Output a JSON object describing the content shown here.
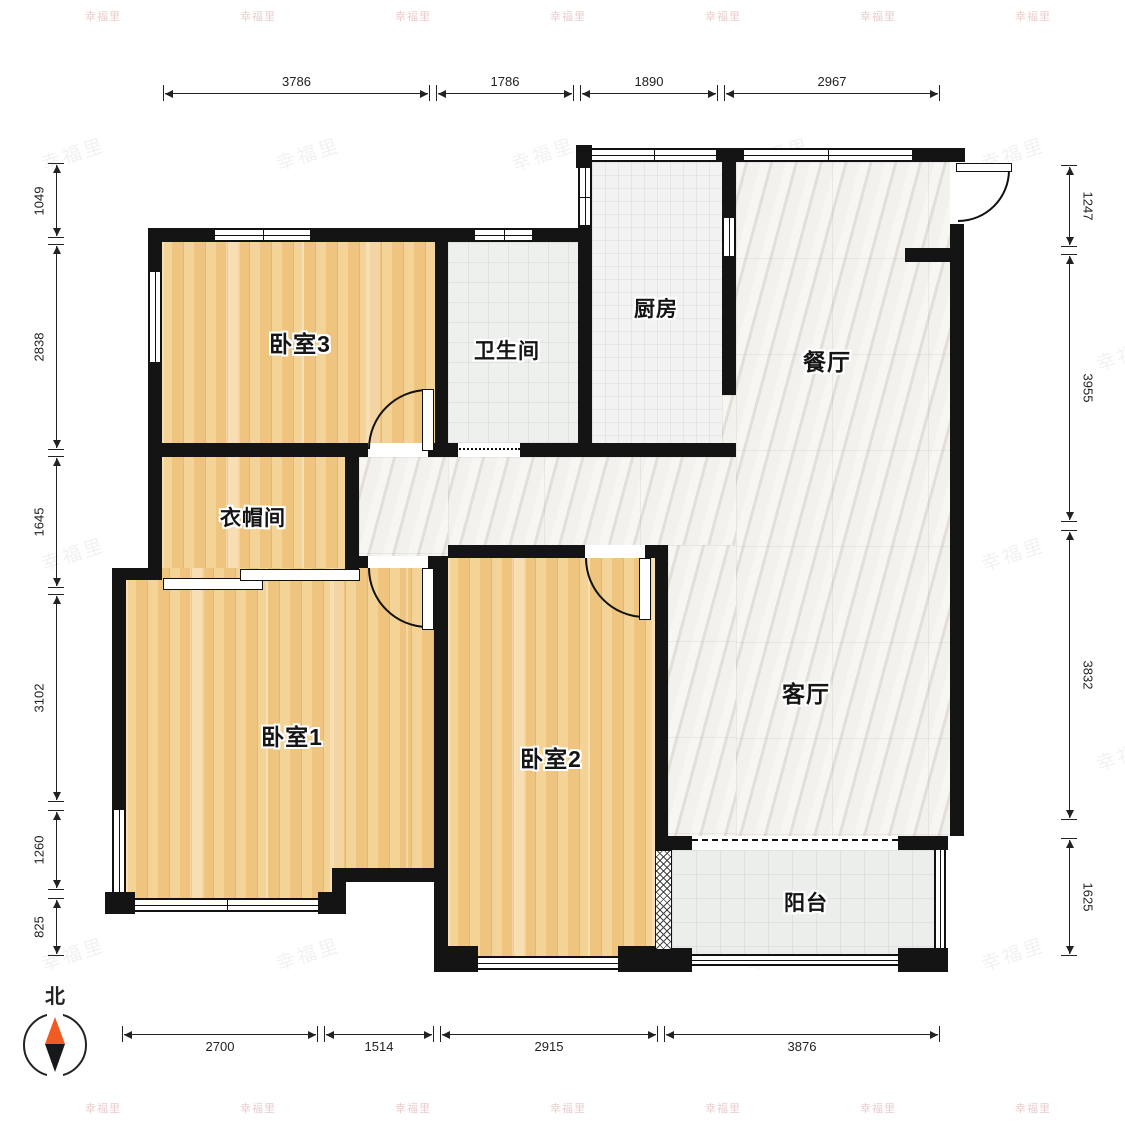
{
  "watermark": {
    "text": "幸福里"
  },
  "compass": {
    "label": "北"
  },
  "rooms": [
    {
      "id": "bedroom3",
      "label": "卧室3"
    },
    {
      "id": "bathroom",
      "label": "卫生间"
    },
    {
      "id": "kitchen",
      "label": "厨房"
    },
    {
      "id": "dining",
      "label": "餐厅"
    },
    {
      "id": "cloakroom",
      "label": "衣帽间"
    },
    {
      "id": "bedroom1",
      "label": "卧室1"
    },
    {
      "id": "bedroom2",
      "label": "卧室2"
    },
    {
      "id": "living",
      "label": "客厅"
    },
    {
      "id": "balcony",
      "label": "阳台"
    }
  ],
  "dimensions": {
    "top": [
      "3786",
      "1786",
      "1890",
      "2967"
    ],
    "bottom": [
      "2700",
      "1514",
      "2915",
      "3876"
    ],
    "left": [
      "1049",
      "2838",
      "1645",
      "3102",
      "1260",
      "825"
    ],
    "right": [
      "1247",
      "3955",
      "3832",
      "1625"
    ]
  },
  "colors": {
    "wall": "#141414",
    "wood_floor": "#f0ca8a",
    "marble_floor": "#edeae5",
    "compass_north": "#f05a23"
  }
}
